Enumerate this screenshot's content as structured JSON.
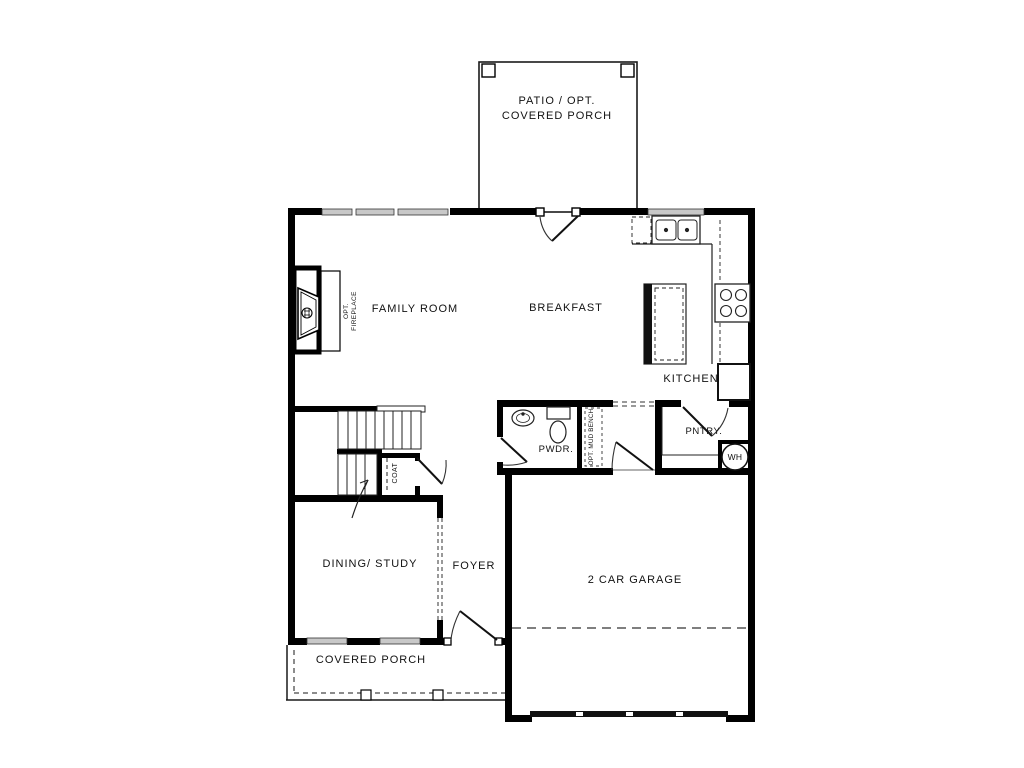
{
  "figure": "first-floor-plan",
  "colors": {
    "wall": "#000000",
    "line": "#1a1a1a",
    "window_fill": "#c8c8c8"
  },
  "rooms": {
    "patio": {
      "label_line1": "PATIO / OPT.",
      "label_line2": "COVERED PORCH"
    },
    "family_room": {
      "label": "FAMILY ROOM"
    },
    "breakfast": {
      "label": "BREAKFAST"
    },
    "kitchen": {
      "label": "KITCHEN"
    },
    "fireplace": {
      "label_line1": "OPT.",
      "label_line2": "FIREPLACE"
    },
    "powder": {
      "label": "PWDR."
    },
    "mud_bench": {
      "label": "OPT. MUD BENCH"
    },
    "pantry": {
      "label": "PNTRY."
    },
    "water_heater": {
      "label": "WH"
    },
    "coat": {
      "label": "COAT"
    },
    "dining_study": {
      "label": "DINING/ STUDY"
    },
    "foyer": {
      "label": "FOYER"
    },
    "garage": {
      "label": "2 CAR GARAGE"
    },
    "covered_porch": {
      "label": "COVERED PORCH"
    }
  }
}
